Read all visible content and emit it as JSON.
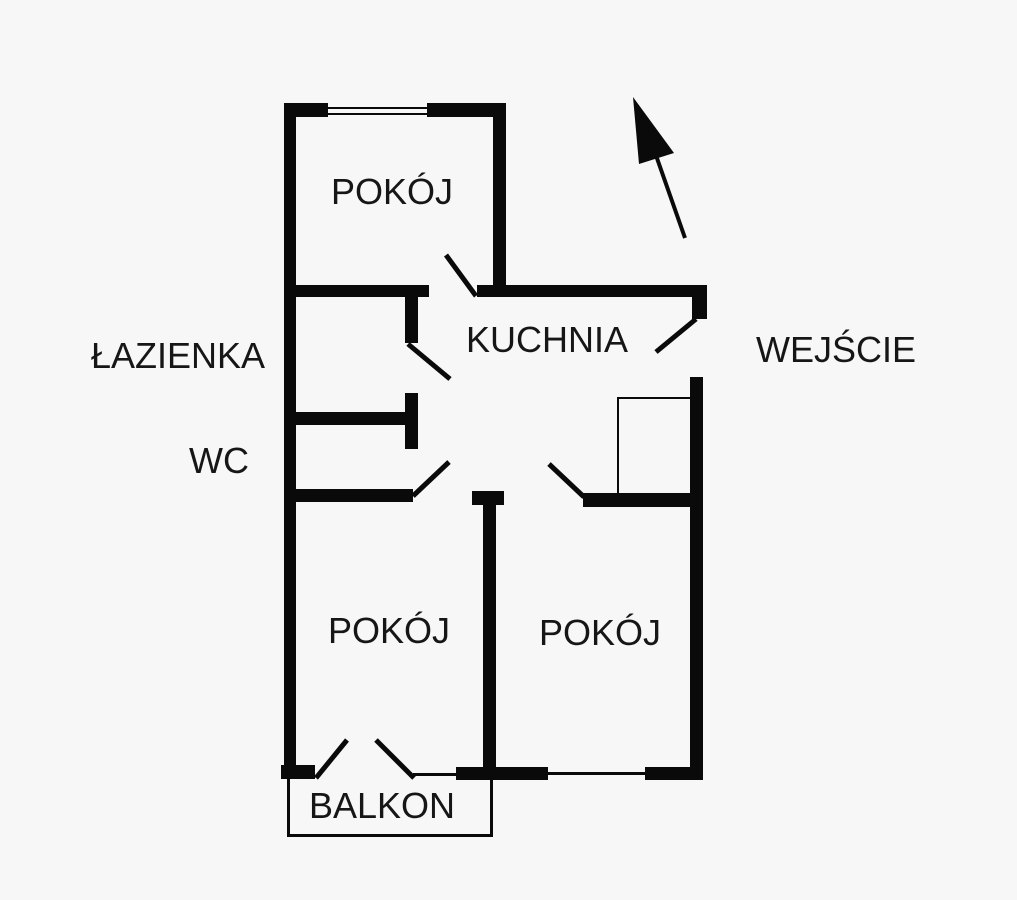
{
  "floorplan": {
    "labels": {
      "pokoj_top": "POKÓJ",
      "lazienka": "ŁAZIENKA",
      "wc": "WC",
      "kuchnia": "KUCHNIA",
      "wejscie": "WEJŚCIE",
      "pokoj_bottom_left": "POKÓJ",
      "pokoj_bottom_right": "POKÓJ",
      "balkon": "BALKON"
    },
    "icons": {
      "north_arrow": "north-arrow"
    },
    "colors": {
      "wall": "#0a0a0a",
      "background": "#f7f7f7",
      "text": "#161616"
    }
  }
}
